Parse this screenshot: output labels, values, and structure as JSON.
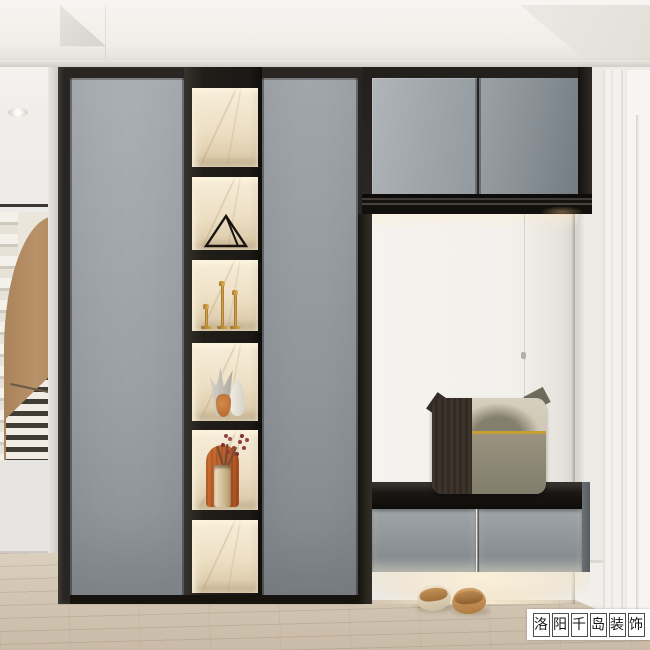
{
  "scene": {
    "description": "Photorealistic interior rendering of a modern entryway: grey wardrobe cabinet with black frame, lit marble display niches with ornaments, suspended upper cabinet over a shoe bench with pillow, slippers on wood floor, white paneled door on the right, arched stair hallway on the left",
    "objects": [
      "wardrobe-doors",
      "display-niches",
      "triangle-ornament",
      "gold-candlesticks",
      "vases",
      "arch-plaque-with-flowers",
      "upper-cabinet",
      "concealed-door-nook",
      "shoe-bench",
      "pillow",
      "slippers",
      "white-interior-door",
      "wood-floor",
      "stair-hallway-view"
    ]
  },
  "watermark": {
    "text": "洛阳千岛装饰",
    "chars": [
      "洛",
      "阳",
      "千",
      "岛",
      "装",
      "饰"
    ]
  },
  "palette": {
    "cabinet_grey": "#9aa0a5",
    "frame_dark": "#282522",
    "marble_cream": "#eddfc4",
    "led_warm": "#fcecd0",
    "gold": "#d9ab52",
    "orange_decor": "#b85c2a",
    "tan_art": "#b08a5e",
    "wood_floor": "#d3c6b3",
    "wall_white": "#f2f0eb",
    "pillow_olive": "#8b8674",
    "pillow_dark": "#38302a"
  }
}
